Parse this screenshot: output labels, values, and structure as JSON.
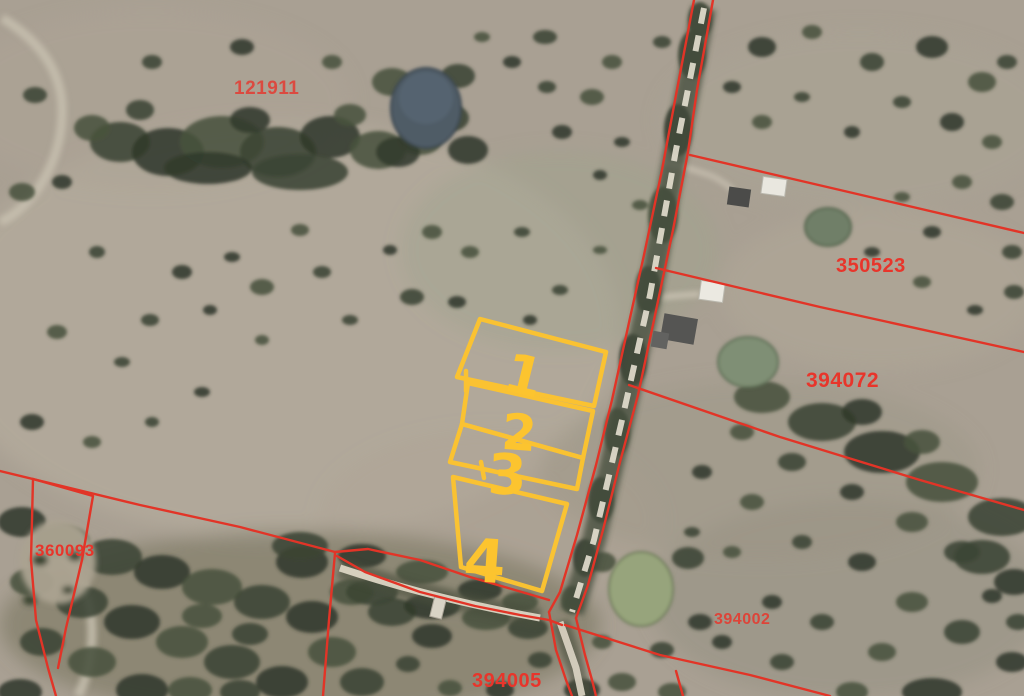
{
  "map": {
    "parcel_labels": [
      {
        "text": "121911"
      },
      {
        "text": "350523"
      },
      {
        "text": "394072"
      },
      {
        "text": "360093"
      },
      {
        "text": "394002"
      },
      {
        "text": "394005"
      }
    ],
    "lot_numbers": [
      {
        "text": "1"
      },
      {
        "text": "2"
      },
      {
        "text": "3"
      },
      {
        "text": "4"
      }
    ],
    "colors": {
      "parcel_line": "#e23427",
      "parcel_label": "#e8352b",
      "lot_highlight": "#fcc42f",
      "terrain_base": "#a9a093",
      "tree_dark": "#3c4534",
      "pond_blue": "#4f5b66",
      "pond_green": "#97a47c",
      "road_surface": "#e6e0d0"
    }
  }
}
